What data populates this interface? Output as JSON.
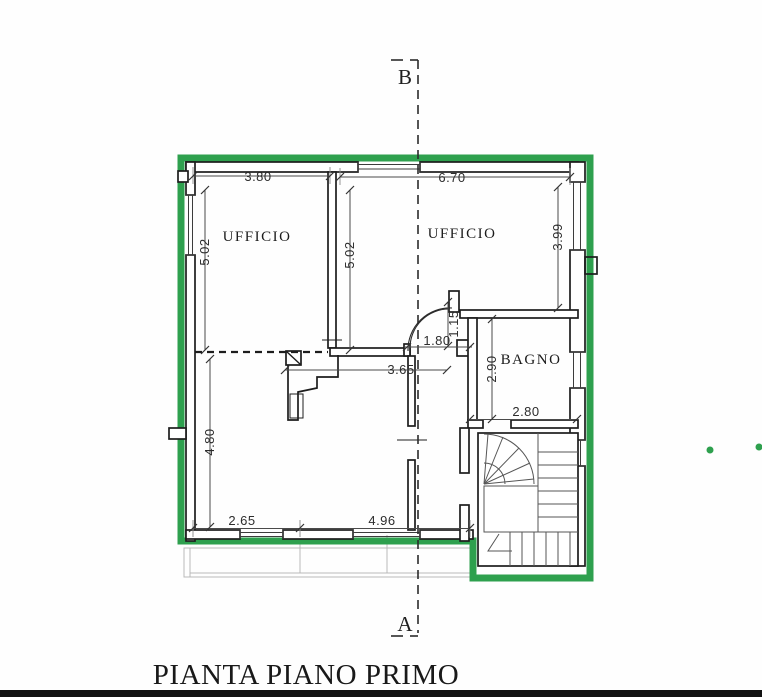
{
  "document": {
    "title": "PIANTA PIANO PRIMO"
  },
  "section_markers": {
    "top": "B",
    "bottom": "A"
  },
  "rooms": {
    "office_left": "UFFICIO",
    "office_right": "UFFICIO",
    "bathroom": "BAGNO"
  },
  "dimensions": {
    "top_left_width": "3.80",
    "top_right_width": "6.70",
    "office_left_height_a": "5.02",
    "office_left_height_b": "5.02",
    "office_right_height": "3.99",
    "door_offset_height": "1.15",
    "door_width": "1.80",
    "hall_width": "3.65",
    "bathroom_height": "2.90",
    "bathroom_width": "2.80",
    "lower_room_height": "4.80",
    "bottom_width_left": "2.65",
    "bottom_width_right": "4.96"
  },
  "colors": {
    "plan_outline_green": "#2ea04e",
    "drawing_line": "#1d1d1d"
  }
}
